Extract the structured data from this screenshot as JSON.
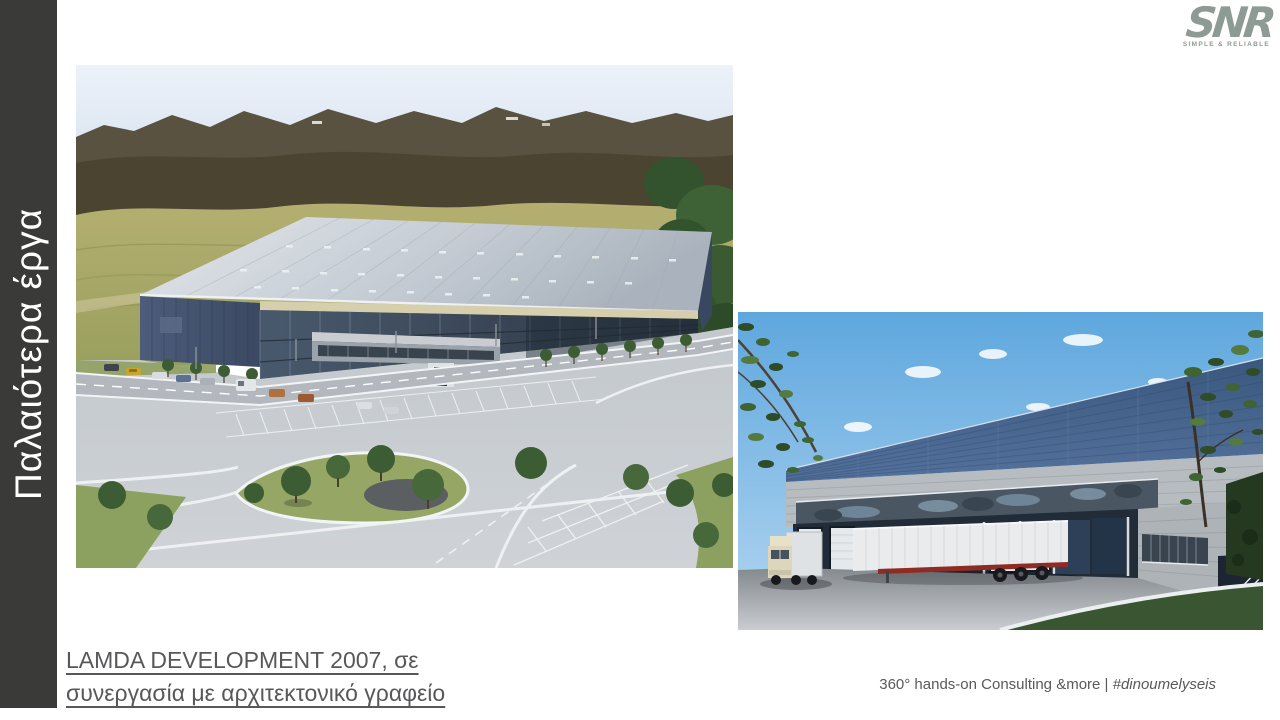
{
  "sidebar": {
    "title": "Παλαιότερα έργα",
    "background_color": "#3a3a38",
    "text_color": "#ffffff"
  },
  "logo": {
    "text": "SNR",
    "tagline": "SIMPLE & RELIABLE",
    "color": "#8d9b94"
  },
  "images": {
    "left": {
      "name": "warehouse-aerial-rendering"
    },
    "right": {
      "name": "warehouse-loading-dock-rendering"
    }
  },
  "caption": {
    "line1": "LAMDA DEVELOPMENT 2007, σε",
    "line2": "συνεργασία με αρχιτεκτονικό γραφείο",
    "color": "#58585a"
  },
  "footer": {
    "text": "360° hands-on Consulting &more | ",
    "hashtag": "#dinoumelyseis",
    "color": "#595959"
  }
}
